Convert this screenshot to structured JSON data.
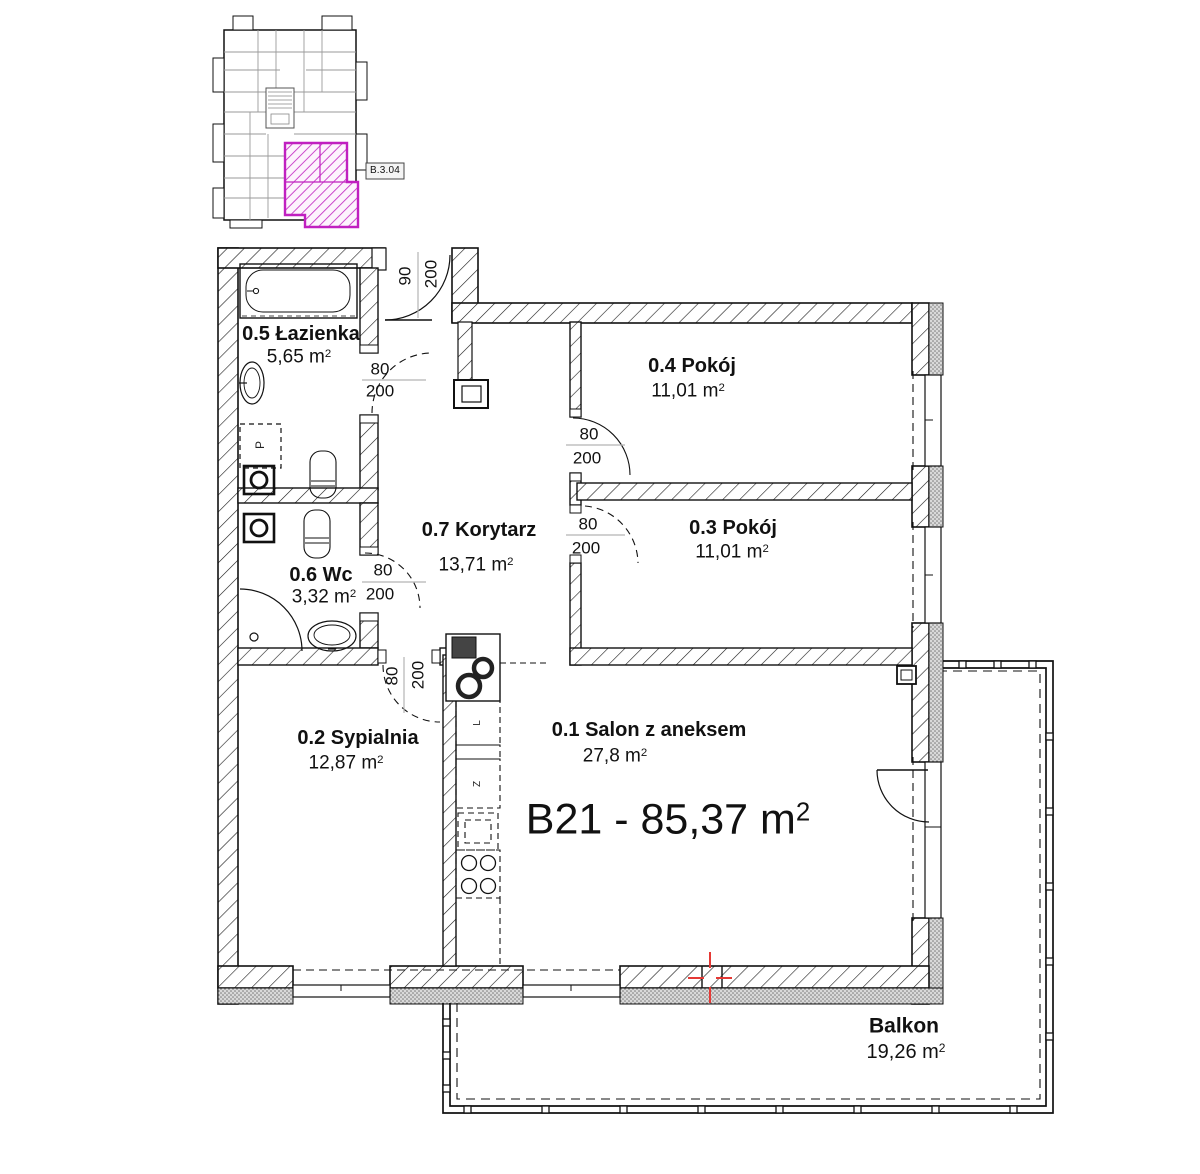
{
  "minimap": {
    "unit_label": "B.3.04"
  },
  "unit": {
    "label": "B21 - 85,37 m"
  },
  "sup": "2",
  "rooms": {
    "lazienka": {
      "name": "0.5 Łazienka",
      "area": "5,65 m"
    },
    "wc": {
      "name": "0.6 Wc",
      "area": "3,32 m"
    },
    "korytarz": {
      "name": "0.7 Korytarz",
      "area": "13,71 m"
    },
    "pokoj04": {
      "name": "0.4 Pokój",
      "area": "11,01 m"
    },
    "pokoj03": {
      "name": "0.3 Pokój",
      "area": "11,01 m"
    },
    "sypialnia": {
      "name": "0.2 Sypialnia",
      "area": "12,87 m"
    },
    "salon": {
      "name": "0.1 Salon z aneksem",
      "area": "27,8 m"
    },
    "balkon": {
      "name": "Balkon",
      "area": "19,26 m"
    }
  },
  "doors": {
    "entrance": {
      "w": "90",
      "h": "200"
    },
    "bathroom": {
      "w": "80",
      "h": "200"
    },
    "wc": {
      "w": "80",
      "h": "200"
    },
    "bedroom": {
      "w": "80",
      "h": "200"
    },
    "pokoj04": {
      "w": "80",
      "h": "200"
    },
    "pokoj03": {
      "w": "80",
      "h": "200"
    }
  },
  "appliances": {
    "washer": "P",
    "fridge": "L",
    "dishwasher": "Z"
  },
  "colors": {
    "highlight": "#c020c0",
    "joint_mark": "#e53935"
  }
}
